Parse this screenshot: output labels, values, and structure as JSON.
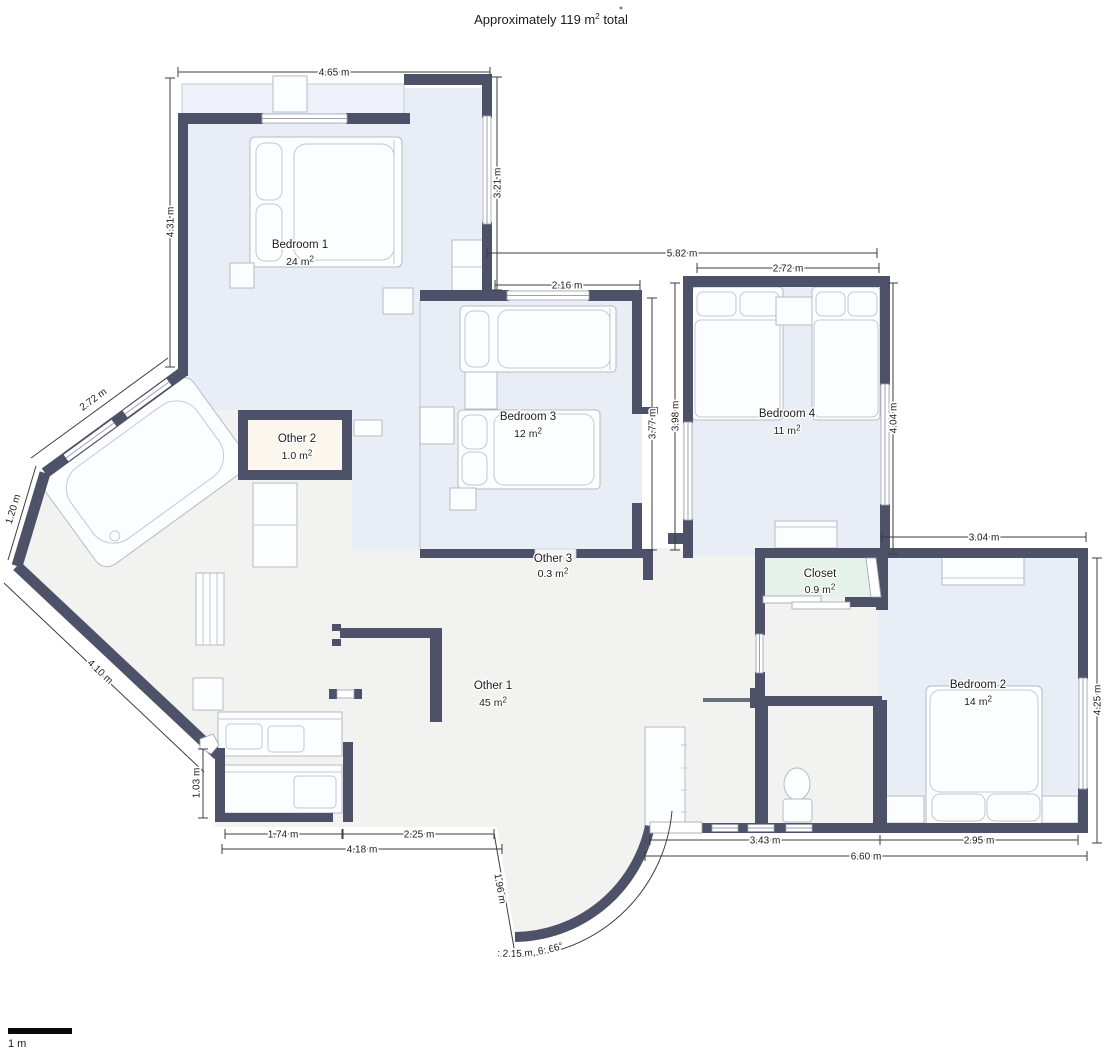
{
  "title": {
    "pre": "Approximately 119 m",
    "sup": "2",
    "post": " total"
  },
  "scale_bar": {
    "label": "1 m"
  },
  "rooms": {
    "bedroom1": {
      "name": "Bedroom 1",
      "area": "24 m",
      "sup": "2"
    },
    "bedroom2": {
      "name": "Bedroom 2",
      "area": "14 m",
      "sup": "2"
    },
    "bedroom3": {
      "name": "Bedroom 3",
      "area": "12 m",
      "sup": "2"
    },
    "bedroom4": {
      "name": "Bedroom 4",
      "area": "11 m",
      "sup": "2"
    },
    "other1": {
      "name": "Other 1",
      "area": "45 m",
      "sup": "2"
    },
    "other2": {
      "name": "Other 2",
      "area": "1.0 m",
      "sup": "2"
    },
    "other3": {
      "name": "Other 3",
      "area": "0.3 m",
      "sup": "2"
    },
    "closet": {
      "name": "Closet",
      "area": "0.9 m",
      "sup": "2"
    }
  },
  "dims": {
    "b1_top": "4.65 m",
    "b1_left": "4.31 m",
    "b1_right": "3.21 m",
    "span_mid": "5.82 m",
    "b3_top": "2.16 m",
    "b4_top": "2.72 m",
    "b3_right": "3.77 m",
    "b4_left": "3.98 m",
    "b4_right": "4.04 m",
    "b2_top": "3.04 m",
    "b2_right": "4.25 m",
    "bath_diag": "2.72 m",
    "bath_short": "1.20 m",
    "bath_long": "4.10 m",
    "kitchen_left": "1.03 m",
    "kitchen_bottom": "1.74 m",
    "hall_bottom": "2.25 m",
    "bottom_left_total": "4.18 m",
    "toilet_bottom": "3.43 m",
    "b2_bottom": "2.95 m",
    "bottom_right_total": "6.60 m",
    "entry": "1.96 m",
    "entry_arc": "2.49 m, r: 2.15 m, θ: 66°"
  },
  "colors": {
    "wall": "#4d5269",
    "bedroom_fill": "#e9edf6",
    "bay_fill": "#eef1f9",
    "floor_fill": "#f2f2f0",
    "other2_fill": "#fbf7ee",
    "closet_fill": "#e4f2e9"
  }
}
